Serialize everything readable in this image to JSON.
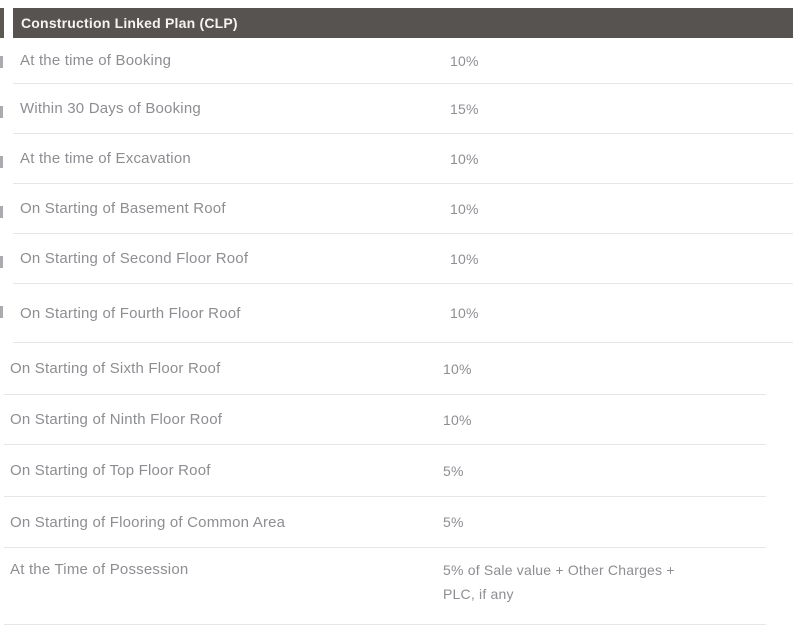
{
  "colors": {
    "page_background": "#ffffff",
    "header_background": "#575350",
    "header_text": "#f5f4f2",
    "row_text": "#8d8e92",
    "divider": "#e6e6e6"
  },
  "table": {
    "title": "Construction Linked Plan (CLP)",
    "sections": [
      {
        "rows": [
          {
            "label": "At the time of Booking",
            "value": "10%"
          },
          {
            "label": "Within 30 Days of Booking",
            "value": "15%"
          },
          {
            "label": "At the time of Excavation",
            "value": "10%"
          },
          {
            "label": "On Starting of Basement Roof",
            "value": "10%"
          },
          {
            "label": "On Starting of Second Floor Roof",
            "value": "10%"
          },
          {
            "label": "On Starting of Fourth Floor Roof",
            "value": "10%"
          }
        ]
      },
      {
        "rows": [
          {
            "label": "On Starting of Sixth Floor Roof",
            "value": "10%"
          },
          {
            "label": "On Starting of Ninth Floor Roof",
            "value": "10%"
          },
          {
            "label": "On Starting of Top Floor Roof",
            "value": "5%"
          },
          {
            "label": "On Starting of Flooring of Common Area",
            "value": "5%"
          },
          {
            "label": "At the Time of Possession",
            "value": "5% of Sale value + Other Charges +\nPLC, if any"
          }
        ]
      }
    ]
  }
}
